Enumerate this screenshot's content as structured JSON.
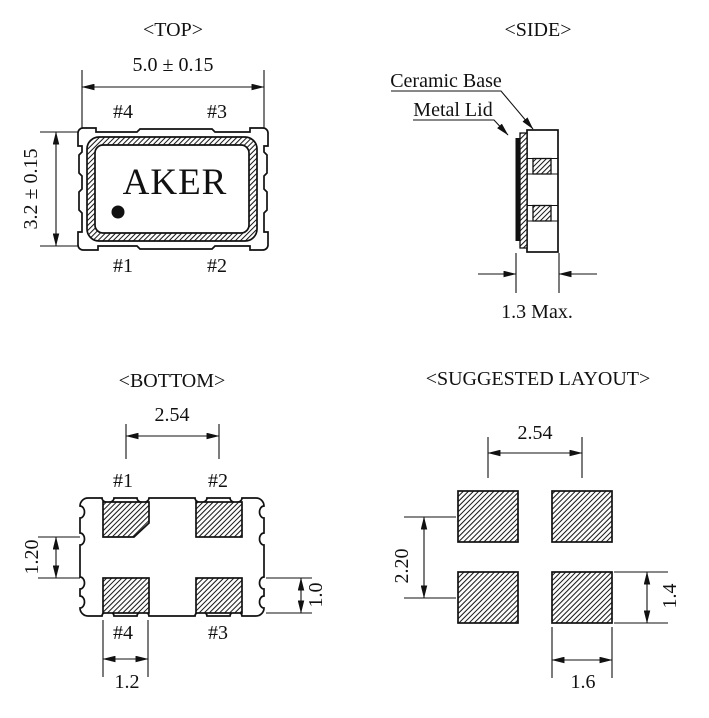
{
  "drawing_title": "Oscillator package outline drawing",
  "colors": {
    "ink": "#111111",
    "paper": "#ffffff"
  },
  "views": {
    "top": {
      "title": "<TOP>",
      "width_dim": "5.0 ± 0.15",
      "height_dim": "3.2 ± 0.15",
      "brand": "AKER",
      "pins": {
        "top_left": "#4",
        "top_right": "#3",
        "bottom_left": "#1",
        "bottom_right": "#2"
      }
    },
    "side": {
      "title": "<SIDE>",
      "ceramic_base_label": "Ceramic Base",
      "metal_lid_label": "Metal Lid",
      "thickness_dim": "1.3 Max."
    },
    "bottom": {
      "title": "<BOTTOM>",
      "pad_pitch_dim": "2.54",
      "pad_gap_dim": "1.20",
      "pad_height_dim": "1.0",
      "pad_width_dim": "1.2",
      "pins": {
        "top_left": "#1",
        "top_right": "#2",
        "bottom_left": "#4",
        "bottom_right": "#3"
      }
    },
    "layout": {
      "title": "<SUGGESTED LAYOUT>",
      "pitch_x_dim": "2.54",
      "pitch_y_dim": "2.20",
      "pad_height_dim": "1.4",
      "pad_width_dim": "1.6"
    }
  }
}
